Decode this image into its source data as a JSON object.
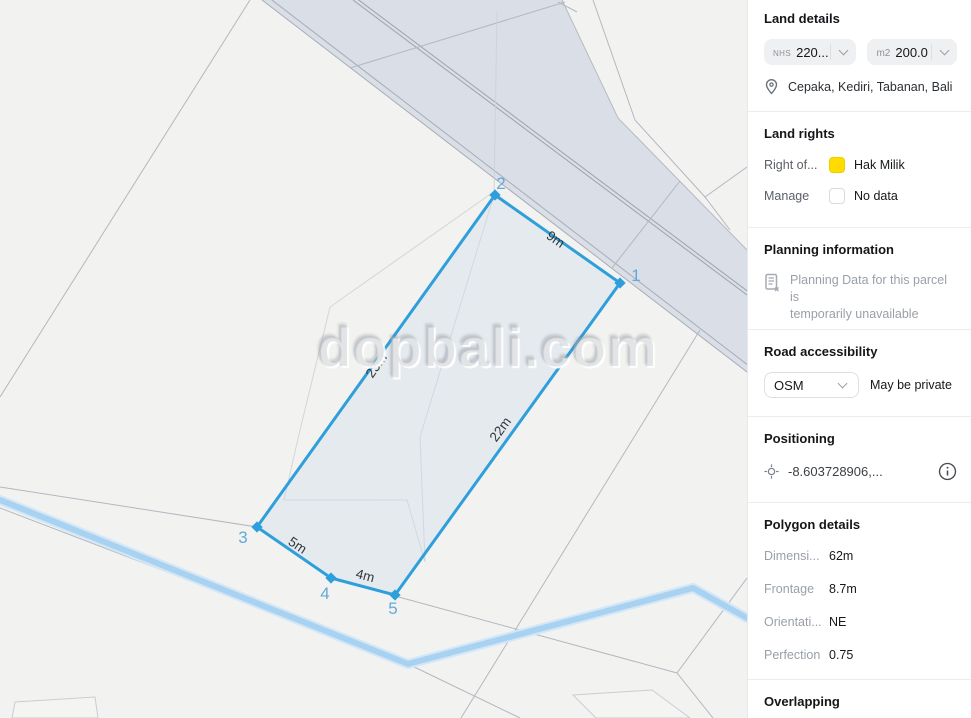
{
  "watermark": "dopbali.com",
  "map": {
    "vertices": [
      {
        "label": "1"
      },
      {
        "label": "2"
      },
      {
        "label": "3"
      },
      {
        "label": "4"
      },
      {
        "label": "5"
      }
    ],
    "edges": [
      {
        "label": "9m"
      },
      {
        "label": "23m"
      },
      {
        "label": "5m"
      },
      {
        "label": "4m"
      },
      {
        "label": "22m"
      }
    ]
  },
  "sidebar": {
    "land_details": {
      "title": "Land details",
      "nhs_prefix": "NHS",
      "nhs_value": "220...",
      "m2_prefix": "m2",
      "m2_value": "200.0",
      "location": "Cepaka, Kediri, Tabanan, Bali"
    },
    "land_rights": {
      "title": "Land rights",
      "rows": [
        {
          "label": "Right of...",
          "value": "Hak Milik",
          "swatch_color": "#ffdb00"
        },
        {
          "label": "Manage",
          "value": "No data",
          "swatch_color": "#ffffff"
        }
      ]
    },
    "planning": {
      "title": "Planning information",
      "message_line1": "Planning Data for this parcel is",
      "message_line2": "temporarily unavailable"
    },
    "road": {
      "title": "Road accessibility",
      "select_value": "OSM",
      "status": "May be private"
    },
    "positioning": {
      "title": "Positioning",
      "coords": "-8.603728906,..."
    },
    "polygon_details": {
      "title": "Polygon details",
      "rows": [
        {
          "label": "Dimensi...",
          "value": "62m"
        },
        {
          "label": "Frontage",
          "value": "8.7m"
        },
        {
          "label": "Orientati...",
          "value": "NE"
        },
        {
          "label": "Perfection",
          "value": "0.75"
        }
      ]
    },
    "overlapping": {
      "title": "Overlapping"
    }
  },
  "colors": {
    "accent_blue": "#2f9fdb",
    "vertex_label_blue": "#64a9d9",
    "right_of_use_yellow": "#ffdb00",
    "road_band": "#d9dee7",
    "stream_blue": "#a9d2f1",
    "map_background": "#f2f2f0",
    "parcel_line": "#b3b8c0"
  }
}
